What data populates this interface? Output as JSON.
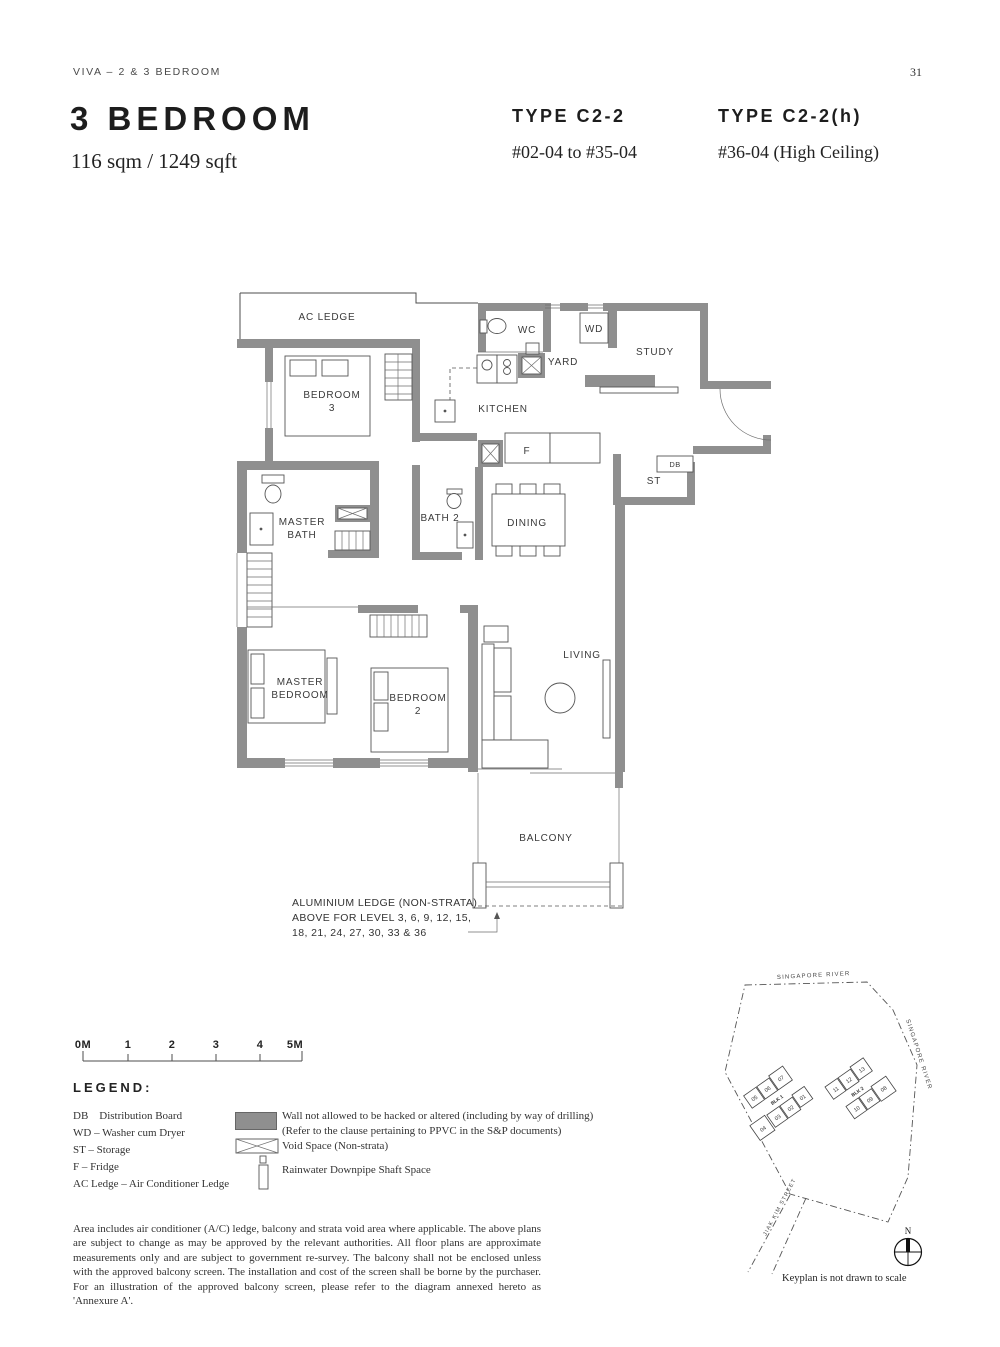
{
  "page": {
    "header": "VIVA – 2 & 3 BEDROOM",
    "page_number": "31"
  },
  "title": {
    "heading": "3 BEDROOM",
    "area": "116 sqm / 1249 sqft"
  },
  "types": [
    {
      "label": "TYPE C2-2",
      "units": "#02-04 to #35-04"
    },
    {
      "label": "TYPE C2-2(h)",
      "units": "#36-04 (High Ceiling)"
    }
  ],
  "floorplan": {
    "wall_color": "#8f8f8f",
    "rooms": {
      "ac_ledge": "AC LEDGE",
      "bedroom3_1": "BEDROOM",
      "bedroom3_2": "3",
      "wc": "WC",
      "wd": "WD",
      "yard": "YARD",
      "study": "STUDY",
      "kitchen": "KITCHEN",
      "fridge": "F",
      "st": "ST",
      "db": "DB",
      "master_bath_1": "MASTER",
      "master_bath_2": "BATH",
      "bath2": "BATH 2",
      "dining": "DINING",
      "master_bedroom_1": "MASTER",
      "master_bedroom_2": "BEDROOM",
      "bedroom2_1": "BEDROOM",
      "bedroom2_2": "2",
      "living": "LIVING",
      "balcony": "BALCONY"
    },
    "note": {
      "l1": "ALUMINIUM LEDGE (NON-STRATA)",
      "l2": "ABOVE FOR LEVEL 3, 6, 9, 12, 15,",
      "l3": "18, 21, 24, 27, 30, 33 & 36"
    }
  },
  "scalebar": {
    "labels": [
      "0M",
      "1",
      "2",
      "3",
      "4",
      "5M"
    ]
  },
  "legend": {
    "heading": "LEGEND:",
    "abbreviations": [
      "DB    Distribution Board",
      "WD – Washer cum Dryer",
      "ST – Storage",
      "F – Fridge",
      "AC Ledge – Air Conditioner Ledge"
    ],
    "symbols": {
      "wall_l1": "Wall not allowed to be hacked or altered (including by way of drilling)",
      "wall_l2": "(Refer to the clause pertaining to PPVC in the S&P documents)",
      "void": "Void Space (Non-strata)",
      "downpipe": "Rainwater Downpipe Shaft Space"
    }
  },
  "disclaimer": "Area includes air conditioner (A/C) ledge, balcony and strata void area where applicable. The above plans are subject to change as may be approved by the relevant authorities. All floor plans are approximate measurements only and are subject to government re-survey. The balcony shall not be enclosed unless with the approved balcony screen. The installation and cost of the screen shall be borne by the purchaser. For an illustration of the approved balcony screen, please refer to the diagram annexed hereto as 'Annexure A'.",
  "keyplan": {
    "river_top": "SINGAPORE RIVER",
    "river_right": "SINGAPORE RIVER",
    "street": "JIAK KIM STREET",
    "blk1": {
      "label": "BLK 1",
      "top": [
        "05",
        "06",
        "07"
      ],
      "bottom": [
        "04",
        "03",
        "02",
        "01"
      ]
    },
    "blk2": {
      "label": "BLK 2",
      "top": [
        "11",
        "12",
        "13"
      ],
      "bottom": [
        "10",
        "09",
        "08"
      ]
    },
    "highlight_unit": "04",
    "highlight_color": "#86a58b",
    "north": "N",
    "caption": "Keyplan is not drawn to scale"
  }
}
